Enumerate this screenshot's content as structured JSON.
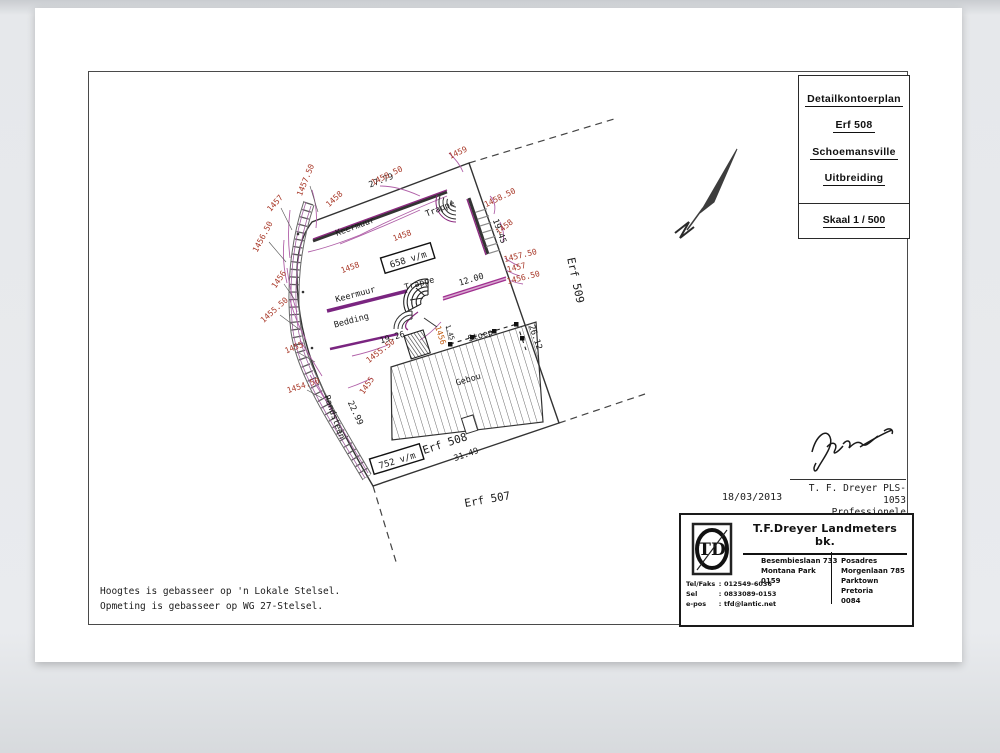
{
  "title_block": {
    "line1": "Detailkontoerplan",
    "line2": "Erf 508",
    "line3": "Schoemansville",
    "line4": "Uitbreiding",
    "scale": "Skaal 1 / 500"
  },
  "plan": {
    "erf": {
      "main": "Erf 508",
      "south": "Erf 507",
      "east": "Erf 509"
    },
    "area": {
      "upper": "658 v/m",
      "lower": "752 v/m"
    },
    "features": {
      "keermuur_top": "Keermuur",
      "trappe_top": "Trappe",
      "keermuur_mid": "Keermuur",
      "trappe_mid": "Trappe",
      "bedding": "Bedding",
      "stoep": "Stoep",
      "gebou": "Gebou",
      "randsteen": "Randsteen"
    },
    "dimensions": {
      "top": "27.79",
      "right_a": "19.45",
      "right_b": "26.12",
      "bottom": "31.49",
      "left": "22.99",
      "wall": "12.00",
      "bedding": "19.26",
      "stoep_side": "1.45"
    },
    "contour_labels": {
      "left": [
        "1457.50",
        "1457",
        "1456.50",
        "1456",
        "1455.50",
        "1455",
        "1454.50"
      ],
      "top": [
        "1459",
        "1458.50",
        "1458"
      ],
      "right": [
        "1458.50",
        "1458",
        "1457.50",
        "1457",
        "1456.50"
      ],
      "inner": [
        "1458",
        "1458",
        "1456",
        "1455.50",
        "1455"
      ]
    }
  },
  "signature": {
    "date": "18/03/2013",
    "name": "T. F. Dreyer PLS-1053",
    "role": "Professionele Landmeter"
  },
  "company": {
    "name": "T.F.Dreyer Landmeters bk.",
    "logo": "TD",
    "sep": ":",
    "office": [
      "Besembieslaan 733",
      "Montana Park",
      "0159"
    ],
    "postal": [
      "Posadres",
      "Morgenlaan 785",
      "Parktown Pretoria",
      "0084"
    ],
    "contacts": [
      {
        "label": "Tel/Faks",
        "value": "012549-6036"
      },
      {
        "label": "Sel",
        "value": "0833089-0153"
      },
      {
        "label": "e-pos",
        "value": "tfd@lantic.net"
      }
    ]
  },
  "notes": [
    "Hoogtes is gebasseer op 'n Lokale Stelsel.",
    "Opmeting is gebasseer op WG 27-Stelsel."
  ],
  "colors": {
    "contour_label": "#a83828",
    "contour_line": "#b060a8",
    "wall": "#7a2580",
    "wall_light": "#a03090",
    "ink": "#1a1a1a"
  }
}
